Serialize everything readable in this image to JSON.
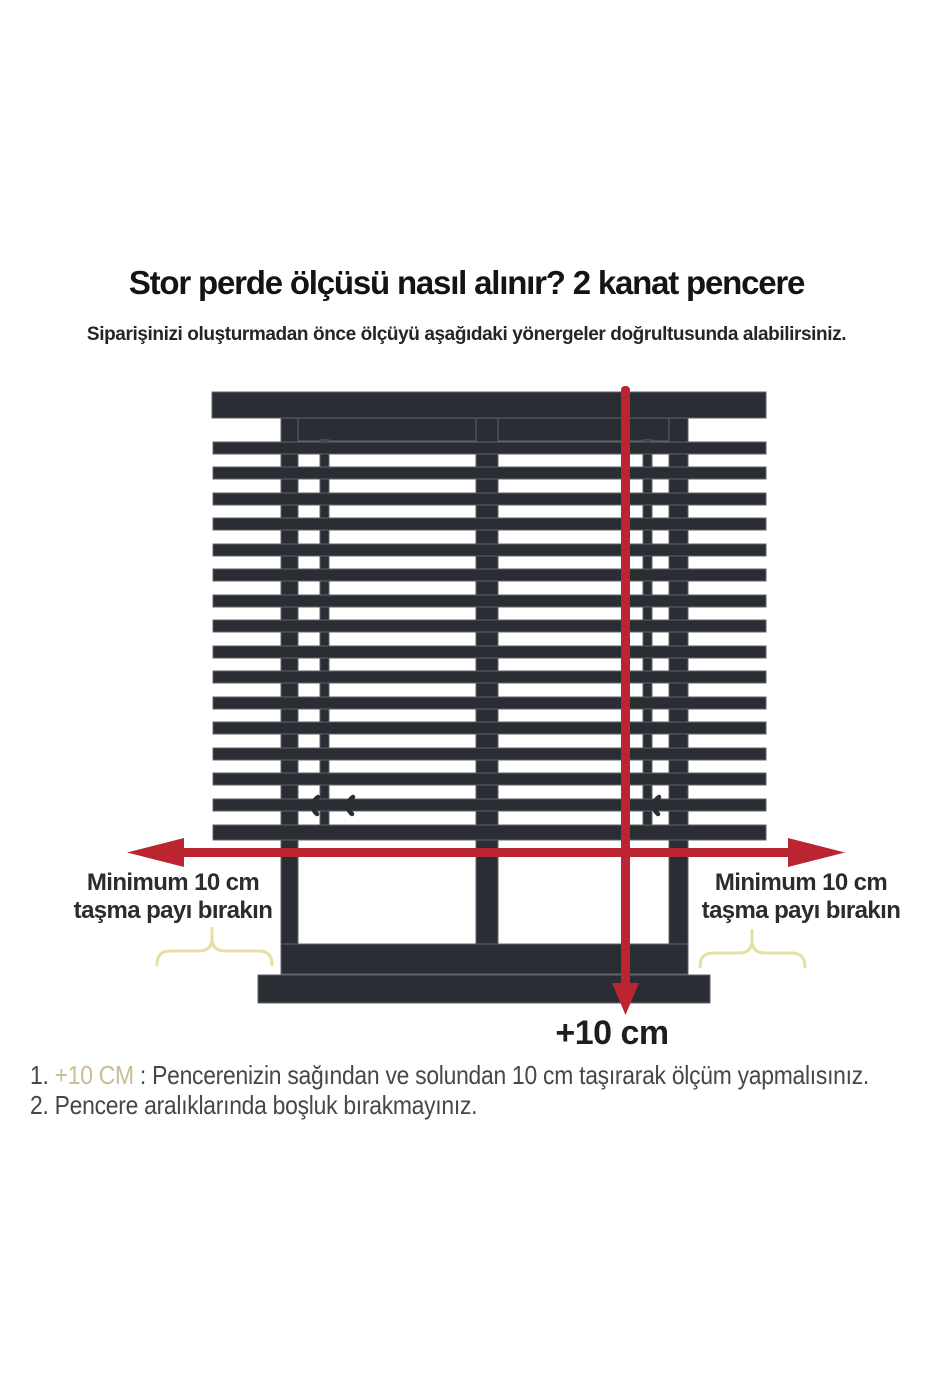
{
  "page": {
    "title": "Stor perde ölçüsü nasıl alınır? 2 kanat pencere",
    "subtitle": "Siparişinizi oluşturmadan önce ölçüyü aşağıdaki yönergeler doğrultusunda alabilirsiniz."
  },
  "diagram": {
    "left_overhang_line1": "Minimum 10 cm",
    "left_overhang_line2": "taşma payı bırakın",
    "right_overhang_line1": "Minimum 10 cm",
    "right_overhang_line2": "taşma payı bırakın",
    "height_extra_label": "+10 cm"
  },
  "notes": [
    {
      "num": "1.",
      "highlight": "+10 CM",
      "text": " : Pencerenizin sağından ve solundan 10 cm taşırarak ölçüm yapmalısınız."
    },
    {
      "num": "2.",
      "highlight": "",
      "text": " Pencere aralıklarında boşluk bırakmayınız."
    }
  ],
  "colors": {
    "arrow_red": "#bb2431",
    "frame_dark": "#2a2d33",
    "brace_yellow": "#e7e0a4",
    "highlight_tan": "#cbbd92"
  }
}
